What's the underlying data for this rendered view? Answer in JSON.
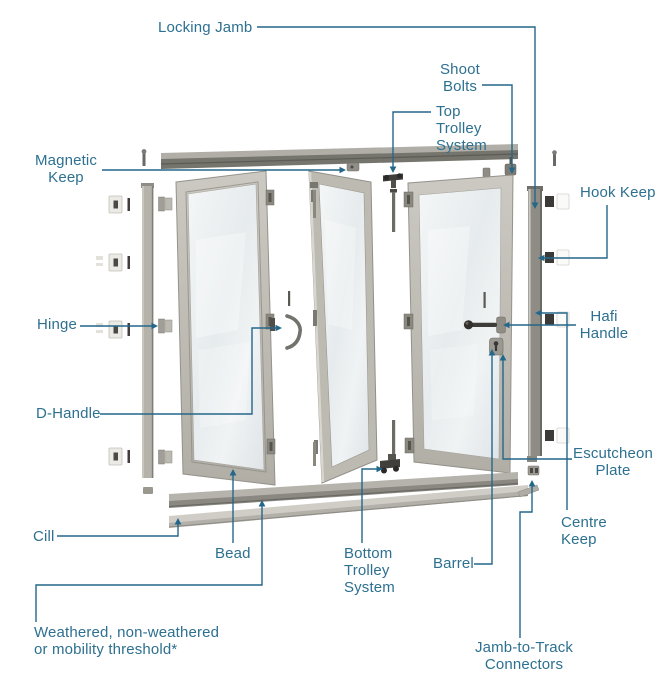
{
  "colors": {
    "background": "#ffffff",
    "label_text": "#2d7090",
    "leader_line": "#24678a"
  },
  "labels": {
    "locking_jamb": "Locking Jamb",
    "shoot_bolts": "Shoot\nBolts",
    "top_trolley_system": "Top\nTrolley\nSystem",
    "magnetic_keep": "Magnetic\nKeep",
    "hook_keep": "Hook Keep",
    "hinge": "Hinge",
    "d_handle": "D-Handle",
    "hafi_handle": "Hafi\nHandle",
    "escutcheon_plate": "Escutcheon\nPlate",
    "centre_keep": "Centre\nKeep",
    "cill": "Cill",
    "bead": "Bead",
    "bottom_trolley_system": "Bottom\nTrolley\nSystem",
    "barrel": "Barrel",
    "jamb_to_track_connectors": "Jamb-to-Track\nConnectors",
    "weathered_threshold": "Weathered, non-weathered\nor mobility threshold*"
  }
}
